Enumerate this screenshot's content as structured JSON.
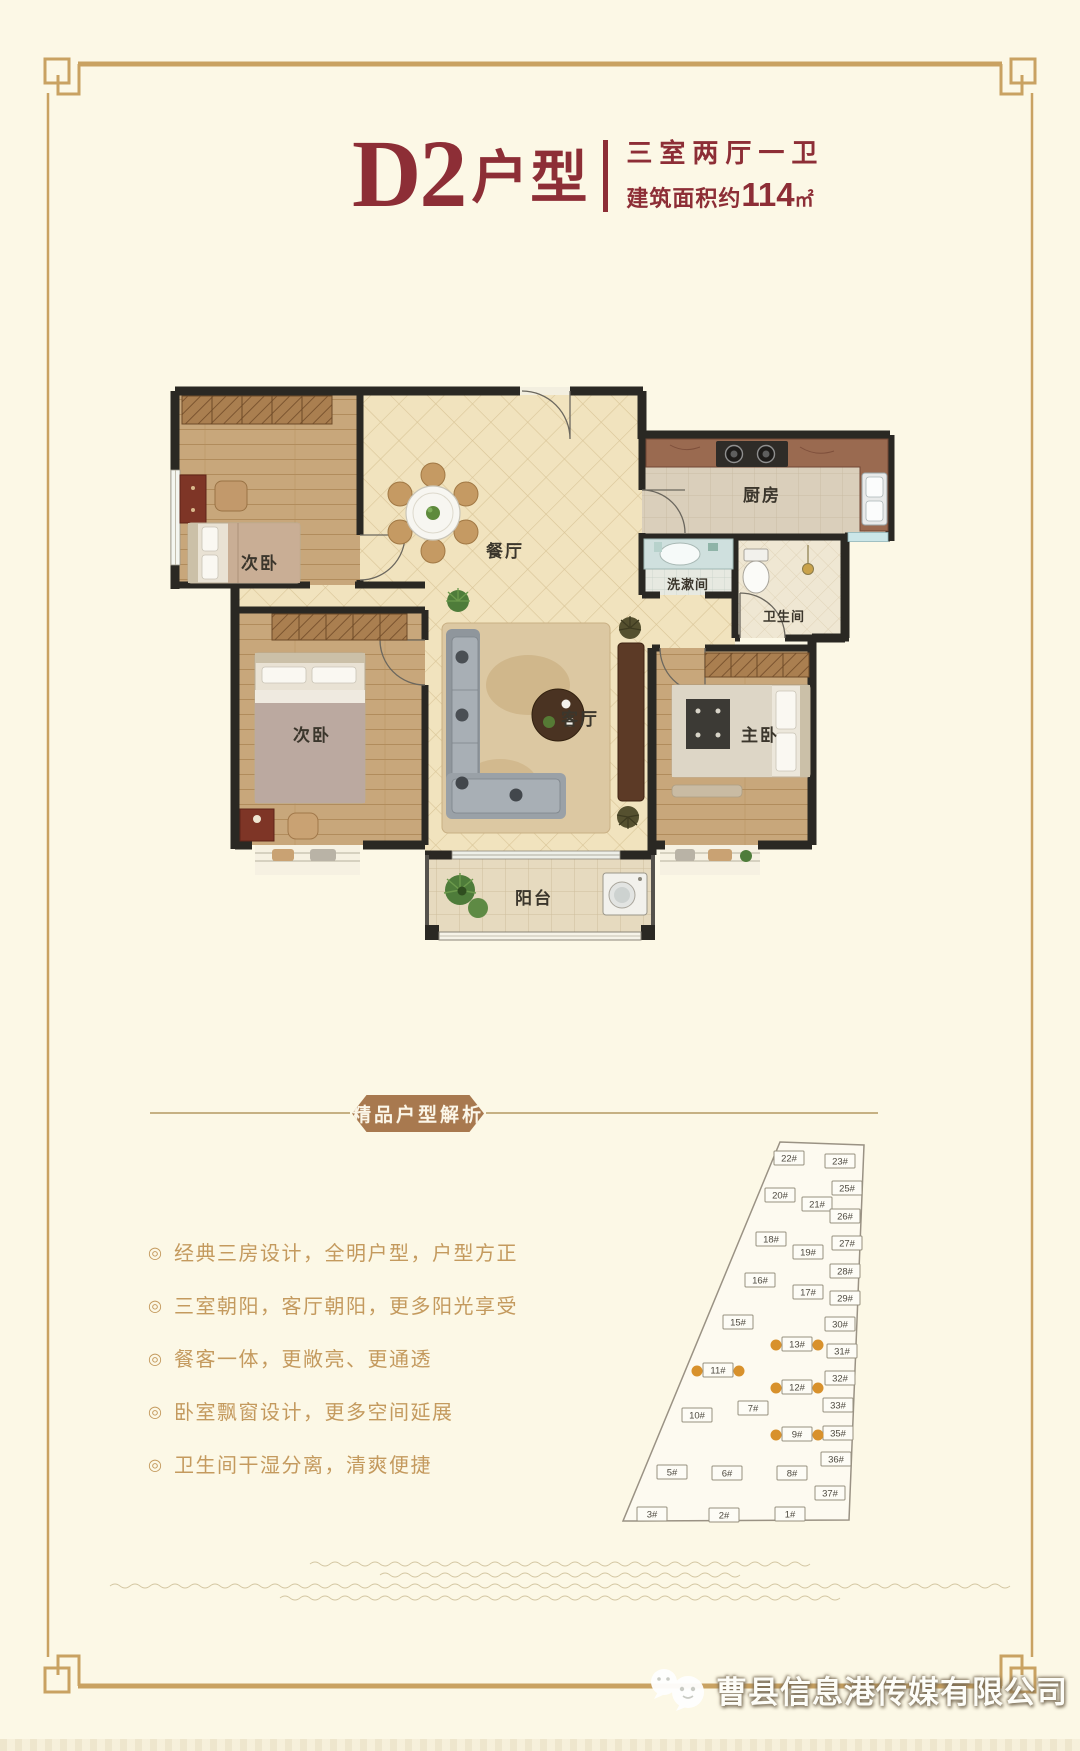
{
  "title": {
    "main": "D2",
    "suffix": "户型",
    "spec": "三室两厅一卫",
    "area_prefix": "建筑面积约",
    "area_value": "114",
    "area_unit": "㎡"
  },
  "floorplan": {
    "rooms": {
      "bedroom1": "次卧",
      "dining": "餐厅",
      "kitchen": "厨房",
      "wash": "洗漱间",
      "bath": "卫生间",
      "bedroom2": "次卧",
      "living": "客厅",
      "master": "主卧",
      "balcony": "阳台"
    }
  },
  "section_banner": "精品户型解析",
  "features": {
    "bullet": "◎",
    "items": [
      {
        "text": "经典三房设计，全明户型，户型方正"
      },
      {
        "text": "三室朝阳，客厅朝阳，更多阳光享受"
      },
      {
        "text": "餐客一体，更敞亮、更通透"
      },
      {
        "text": "卧室飘窗设计，更多空间延展"
      },
      {
        "text": "卫生间干湿分离，清爽便捷"
      }
    ]
  },
  "siteplan": {
    "buildings": [
      {
        "label": "22#",
        "x": 244,
        "y": 30,
        "hl": false
      },
      {
        "label": "23#",
        "x": 295,
        "y": 33,
        "hl": false
      },
      {
        "label": "25#",
        "x": 302,
        "y": 60,
        "hl": false
      },
      {
        "label": "20#",
        "x": 235,
        "y": 67,
        "hl": false
      },
      {
        "label": "21#",
        "x": 272,
        "y": 76,
        "hl": false
      },
      {
        "label": "26#",
        "x": 300,
        "y": 88,
        "hl": false
      },
      {
        "label": "18#",
        "x": 226,
        "y": 111,
        "hl": false
      },
      {
        "label": "27#",
        "x": 302,
        "y": 115,
        "hl": false
      },
      {
        "label": "19#",
        "x": 263,
        "y": 124,
        "hl": false
      },
      {
        "label": "28#",
        "x": 300,
        "y": 143,
        "hl": false
      },
      {
        "label": "16#",
        "x": 215,
        "y": 152,
        "hl": false
      },
      {
        "label": "17#",
        "x": 263,
        "y": 164,
        "hl": false
      },
      {
        "label": "29#",
        "x": 300,
        "y": 170,
        "hl": false
      },
      {
        "label": "15#",
        "x": 193,
        "y": 194,
        "hl": false
      },
      {
        "label": "30#",
        "x": 295,
        "y": 196,
        "hl": false
      },
      {
        "label": "13#",
        "x": 252,
        "y": 216,
        "hl": true
      },
      {
        "label": "31#",
        "x": 297,
        "y": 223,
        "hl": false
      },
      {
        "label": "11#",
        "x": 173,
        "y": 242,
        "hl": true
      },
      {
        "label": "32#",
        "x": 295,
        "y": 250,
        "hl": false
      },
      {
        "label": "12#",
        "x": 252,
        "y": 259,
        "hl": true
      },
      {
        "label": "33#",
        "x": 293,
        "y": 277,
        "hl": false
      },
      {
        "label": "7#",
        "x": 208,
        "y": 280,
        "hl": false
      },
      {
        "label": "10#",
        "x": 152,
        "y": 287,
        "hl": false
      },
      {
        "label": "35#",
        "x": 293,
        "y": 305,
        "hl": false
      },
      {
        "label": "9#",
        "x": 252,
        "y": 306,
        "hl": true
      },
      {
        "label": "36#",
        "x": 291,
        "y": 331,
        "hl": false
      },
      {
        "label": "5#",
        "x": 127,
        "y": 344,
        "hl": false
      },
      {
        "label": "6#",
        "x": 182,
        "y": 345,
        "hl": false
      },
      {
        "label": "8#",
        "x": 247,
        "y": 345,
        "hl": false
      },
      {
        "label": "37#",
        "x": 285,
        "y": 365,
        "hl": false
      },
      {
        "label": "3#",
        "x": 107,
        "y": 386,
        "hl": false
      },
      {
        "label": "2#",
        "x": 179,
        "y": 387,
        "hl": false
      },
      {
        "label": "1#",
        "x": 245,
        "y": 386,
        "hl": false
      }
    ]
  },
  "watermark": {
    "company": "曹县信息港传媒有限公司"
  },
  "colors": {
    "background": "#FCF8E6",
    "accent_red": "#8D2E36",
    "frame_gold": "#C9A262",
    "banner_brown": "#A8794F",
    "feature_gold": "#C49A5E",
    "wall_dark": "#2A2823",
    "highlight_orange": "#D8912C"
  }
}
